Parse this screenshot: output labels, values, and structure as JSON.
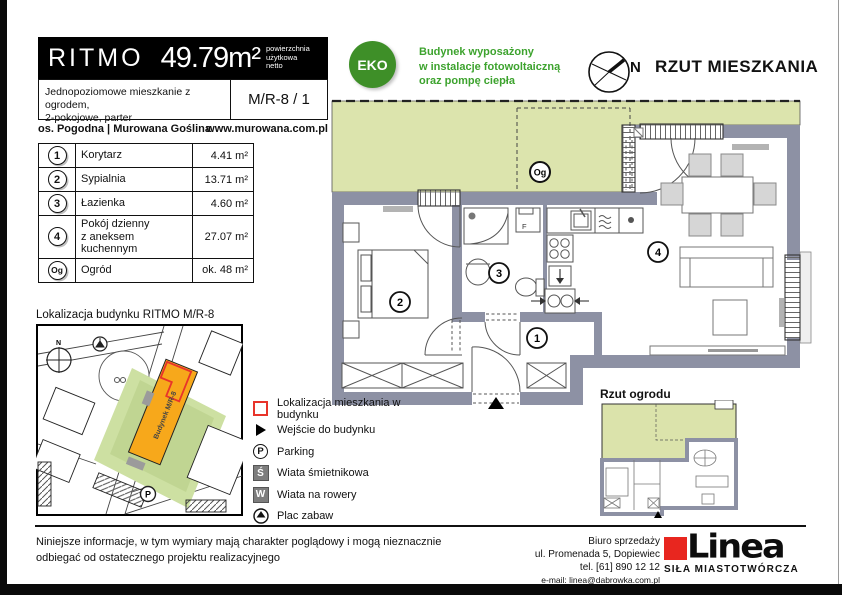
{
  "header": {
    "brand": "RITMO",
    "area": "49.79m²",
    "area_note": [
      "powierzchnia",
      "użytkowa",
      "netto"
    ],
    "description": [
      "Jednopoziomowe mieszkanie z ogrodem,",
      "2-pokojowe, parter"
    ],
    "unit_code": "M/R-8 / 1",
    "estate": "os. Pogodna | Murowana Goślina",
    "website": "www.murowana.com.pl"
  },
  "eco": {
    "badge": "EKO",
    "lines": [
      "Budynek wyposażony",
      "w instalacje fotowoltaiczną",
      "oraz pompę ciepła"
    ]
  },
  "plan": {
    "title": "RZUT MIESZKANIA",
    "compass": "N",
    "labels": {
      "hall": "1",
      "bedroom": "2",
      "bath": "3",
      "living": "4",
      "garden": "Og",
      "f": "F"
    }
  },
  "rooms": {
    "rows": [
      {
        "no": "1",
        "name": "Korytarz",
        "name2": "",
        "area": "4.41 m²"
      },
      {
        "no": "2",
        "name": "Sypialnia",
        "name2": "",
        "area": "13.71 m²"
      },
      {
        "no": "3",
        "name": "Łazienka",
        "name2": "",
        "area": "4.60 m²"
      },
      {
        "no": "4",
        "name": "Pokój dzienny",
        "name2": "z aneksem kuchennym",
        "area": "27.07 m²"
      },
      {
        "no": "Og",
        "name": "Ogród",
        "name2": "",
        "area": "ok. 48 m²"
      }
    ]
  },
  "location_map": {
    "title": "Lokalizacja budynku RITMO M/R-8",
    "building_label": "Budynek M/R-8",
    "compass": "N",
    "parking": "P"
  },
  "legend": {
    "items": [
      {
        "label": "Lokalizacja mieszkania w budynku"
      },
      {
        "label": "Wejście do budynku"
      },
      {
        "label": "Parking"
      },
      {
        "label": "Wiata śmietnikowa"
      },
      {
        "label": "Wiata na rowery"
      },
      {
        "label": "Plac zabaw"
      }
    ],
    "parking_letter": "P",
    "trash_letter": "Ś",
    "bike_letter": "W"
  },
  "garden_plan": {
    "title": "Rzut ogrodu"
  },
  "footer": {
    "disclaimer": [
      "Niniejsze informacje, w tym wymiary mają charakter poglądowy i mogą nieznacznie",
      "odbiegać od ostatecznego projektu realizacyjnego"
    ],
    "office": [
      "Biuro sprzedaży",
      "ul. Promenada 5, Dopiewiec",
      "tel. [61] 890 12 12",
      "e-mail: linea@dabrowka.com.pl"
    ],
    "logo": "Linea",
    "tagline": "SIŁA MIASTOTWÓRCZA"
  },
  "colors": {
    "wall": "#8d91a4",
    "garden": "#dce4ad",
    "eco_green": "#3e8f28",
    "accent_red": "#e8342a",
    "map_orange": "#f7a81b"
  }
}
